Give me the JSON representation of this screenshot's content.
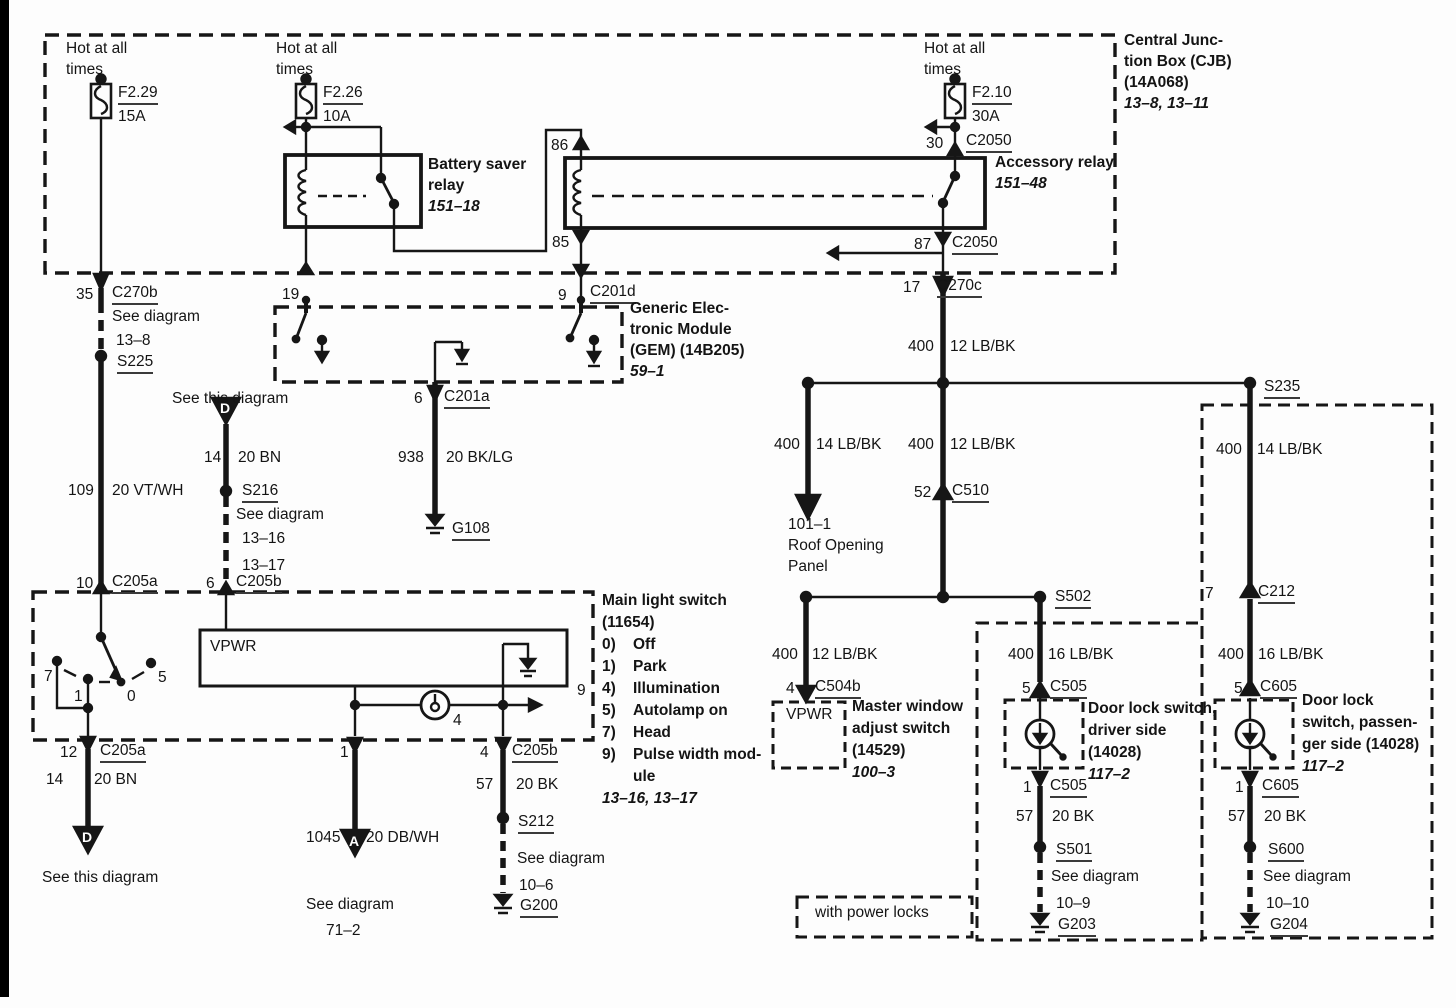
{
  "colors": {
    "ink": "#161616",
    "paper": "#fdfdfd"
  },
  "labels": [
    {
      "n": "hot-at-all-times-1a",
      "t": "Hot at all",
      "x": 66,
      "y": 40,
      "c": ""
    },
    {
      "n": "hot-at-all-times-1b",
      "t": "times",
      "x": 66,
      "y": 61,
      "c": ""
    },
    {
      "n": "fuse-f229-name",
      "t": "F2.29",
      "x": 118,
      "y": 84,
      "c": "u"
    },
    {
      "n": "fuse-f229-rating",
      "t": "15A",
      "x": 118,
      "y": 108,
      "c": ""
    },
    {
      "n": "hot-at-all-times-2a",
      "t": "Hot at all",
      "x": 276,
      "y": 40,
      "c": ""
    },
    {
      "n": "hot-at-all-times-2b",
      "t": "times",
      "x": 276,
      "y": 61,
      "c": ""
    },
    {
      "n": "fuse-f226-name",
      "t": "F2.26",
      "x": 323,
      "y": 84,
      "c": "u"
    },
    {
      "n": "fuse-f226-rating",
      "t": "10A",
      "x": 323,
      "y": 108,
      "c": ""
    },
    {
      "n": "hot-at-all-times-3a",
      "t": "Hot at all",
      "x": 924,
      "y": 40,
      "c": ""
    },
    {
      "n": "hot-at-all-times-3b",
      "t": "times",
      "x": 924,
      "y": 61,
      "c": ""
    },
    {
      "n": "fuse-f210-name",
      "t": "F2.10",
      "x": 972,
      "y": 84,
      "c": "u"
    },
    {
      "n": "fuse-f210-rating",
      "t": "30A",
      "x": 972,
      "y": 108,
      "c": ""
    },
    {
      "n": "cjb-title-1",
      "t": "Central Junc-",
      "x": 1124,
      "y": 32,
      "c": "b"
    },
    {
      "n": "cjb-title-2",
      "t": "tion Box (CJB)",
      "x": 1124,
      "y": 53,
      "c": "b"
    },
    {
      "n": "cjb-title-3",
      "t": "(14A068)",
      "x": 1124,
      "y": 74,
      "c": "b"
    },
    {
      "n": "cjb-page-ref",
      "t": "13–8, 13–11",
      "x": 1124,
      "y": 95,
      "c": "bi"
    },
    {
      "n": "battery-saver-relay-1",
      "t": "Battery saver",
      "x": 428,
      "y": 156,
      "c": "b"
    },
    {
      "n": "battery-saver-relay-2",
      "t": "relay",
      "x": 428,
      "y": 177,
      "c": "b"
    },
    {
      "n": "battery-saver-relay-ref",
      "t": "151–18",
      "x": 428,
      "y": 198,
      "c": "bi"
    },
    {
      "n": "accessory-relay-1",
      "t": "Accessory relay",
      "x": 995,
      "y": 154,
      "c": "b"
    },
    {
      "n": "accessory-relay-ref",
      "t": "151–48",
      "x": 995,
      "y": 175,
      "c": "bi"
    },
    {
      "n": "pin-86",
      "t": "86",
      "x": 551,
      "y": 137,
      "c": ""
    },
    {
      "n": "pin-85",
      "t": "85",
      "x": 552,
      "y": 234,
      "c": ""
    },
    {
      "n": "pin-30",
      "t": "30",
      "x": 926,
      "y": 135,
      "c": ""
    },
    {
      "n": "conn-c2050-top",
      "t": "C2050",
      "x": 966,
      "y": 132,
      "c": "u"
    },
    {
      "n": "pin-87",
      "t": "87",
      "x": 914,
      "y": 236,
      "c": ""
    },
    {
      "n": "conn-c2050-bottom",
      "t": "C2050",
      "x": 952,
      "y": 234,
      "c": "u"
    },
    {
      "n": "pin-35",
      "t": "35",
      "x": 76,
      "y": 286,
      "c": ""
    },
    {
      "n": "conn-c270b",
      "t": "C270b",
      "x": 112,
      "y": 284,
      "c": "u"
    },
    {
      "n": "pin-19",
      "t": "19",
      "x": 282,
      "y": 286,
      "c": ""
    },
    {
      "n": "pin-9-c201d",
      "t": "9",
      "x": 558,
      "y": 287,
      "c": ""
    },
    {
      "n": "conn-c201d",
      "t": "C201d",
      "x": 590,
      "y": 283,
      "c": "u"
    },
    {
      "n": "pin-17",
      "t": "17",
      "x": 903,
      "y": 279,
      "c": ""
    },
    {
      "n": "conn-c270c",
      "t": "C270c",
      "x": 937,
      "y": 277,
      "c": "u"
    },
    {
      "n": "see-diagram-13-8a",
      "t": "See diagram",
      "x": 112,
      "y": 308,
      "c": ""
    },
    {
      "n": "see-diagram-13-8b",
      "t": "13–8",
      "x": 116,
      "y": 332,
      "c": ""
    },
    {
      "n": "splice-s225",
      "t": "S225",
      "x": 117,
      "y": 353,
      "c": "u"
    },
    {
      "n": "gem-title-1",
      "t": "Generic Elec-",
      "x": 630,
      "y": 300,
      "c": "b"
    },
    {
      "n": "gem-title-2",
      "t": "tronic Module",
      "x": 630,
      "y": 321,
      "c": "b"
    },
    {
      "n": "gem-title-3",
      "t": "(GEM) (14B205)",
      "x": 630,
      "y": 342,
      "c": "b"
    },
    {
      "n": "gem-page-ref",
      "t": "59–1",
      "x": 630,
      "y": 363,
      "c": "bi"
    },
    {
      "n": "pin-6-c201a",
      "t": "6",
      "x": 414,
      "y": 390,
      "c": ""
    },
    {
      "n": "conn-c201a",
      "t": "C201a",
      "x": 444,
      "y": 388,
      "c": "u"
    },
    {
      "n": "wire-938-num",
      "t": "938",
      "x": 398,
      "y": 449,
      "c": ""
    },
    {
      "n": "wire-938-color",
      "t": "20 BK/LG",
      "x": 446,
      "y": 449,
      "c": ""
    },
    {
      "n": "ground-g108",
      "t": "G108",
      "x": 452,
      "y": 520,
      "c": "u"
    },
    {
      "n": "see-this-diagram-top",
      "t": "See this diagram",
      "x": 172,
      "y": 390,
      "c": ""
    },
    {
      "n": "wire-14-top-num",
      "t": "14",
      "x": 204,
      "y": 449,
      "c": ""
    },
    {
      "n": "wire-14-top-color",
      "t": "20 BN",
      "x": 238,
      "y": 449,
      "c": ""
    },
    {
      "n": "splice-s216",
      "t": "S216",
      "x": 242,
      "y": 482,
      "c": "u"
    },
    {
      "n": "see-diagram-1316a",
      "t": "See diagram",
      "x": 236,
      "y": 506,
      "c": ""
    },
    {
      "n": "see-diagram-1316b",
      "t": "13–16",
      "x": 242,
      "y": 530,
      "c": ""
    },
    {
      "n": "see-diagram-1316c",
      "t": "13–17",
      "x": 242,
      "y": 557,
      "c": ""
    },
    {
      "n": "wire-109-num",
      "t": "109",
      "x": 68,
      "y": 482,
      "c": ""
    },
    {
      "n": "wire-109-color",
      "t": "20 VT/WH",
      "x": 112,
      "y": 482,
      "c": ""
    },
    {
      "n": "pin-10",
      "t": "10",
      "x": 76,
      "y": 575,
      "c": ""
    },
    {
      "n": "conn-c205a-top",
      "t": "C205a",
      "x": 112,
      "y": 573,
      "c": "u"
    },
    {
      "n": "pin-6-c205b",
      "t": "6",
      "x": 206,
      "y": 575,
      "c": ""
    },
    {
      "n": "conn-c205b-top",
      "t": "C205b",
      "x": 236,
      "y": 573,
      "c": "u"
    },
    {
      "n": "mls-title-1",
      "t": "Main light switch",
      "x": 602,
      "y": 592,
      "c": "b"
    },
    {
      "n": "mls-title-2",
      "t": "(11654)",
      "x": 602,
      "y": 614,
      "c": "b"
    },
    {
      "n": "mls-opt0-num",
      "t": "0)",
      "x": 602,
      "y": 636,
      "c": "b"
    },
    {
      "n": "mls-opt0-val",
      "t": "Off",
      "x": 633,
      "y": 636,
      "c": "b"
    },
    {
      "n": "mls-opt1-num",
      "t": "1)",
      "x": 602,
      "y": 658,
      "c": "b"
    },
    {
      "n": "mls-opt1-val",
      "t": "Park",
      "x": 633,
      "y": 658,
      "c": "b"
    },
    {
      "n": "mls-opt4-num",
      "t": "4)",
      "x": 602,
      "y": 680,
      "c": "b"
    },
    {
      "n": "mls-opt4-val",
      "t": "Illumination",
      "x": 633,
      "y": 680,
      "c": "b"
    },
    {
      "n": "mls-opt5-num",
      "t": "5)",
      "x": 602,
      "y": 702,
      "c": "b"
    },
    {
      "n": "mls-opt5-val",
      "t": "Autolamp on",
      "x": 633,
      "y": 702,
      "c": "b"
    },
    {
      "n": "mls-opt7-num",
      "t": "7)",
      "x": 602,
      "y": 724,
      "c": "b"
    },
    {
      "n": "mls-opt7-val",
      "t": "Head",
      "x": 633,
      "y": 724,
      "c": "b"
    },
    {
      "n": "mls-opt9-num",
      "t": "9)",
      "x": 602,
      "y": 746,
      "c": "b"
    },
    {
      "n": "mls-opt9-val",
      "t": "Pulse width mod-",
      "x": 633,
      "y": 746,
      "c": "b"
    },
    {
      "n": "mls-opt9-val2",
      "t": "ule",
      "x": 633,
      "y": 768,
      "c": "b"
    },
    {
      "n": "mls-page-ref",
      "t": "13–16, 13–17",
      "x": 602,
      "y": 790,
      "c": "bi"
    },
    {
      "n": "vpwr-mls",
      "t": "VPWR",
      "x": 210,
      "y": 638,
      "c": ""
    },
    {
      "n": "rotary-pos-7",
      "t": "7",
      "x": 44,
      "y": 668,
      "c": ""
    },
    {
      "n": "rotary-pos-1",
      "t": "1",
      "x": 74,
      "y": 688,
      "c": ""
    },
    {
      "n": "rotary-pos-0",
      "t": "0",
      "x": 127,
      "y": 688,
      "c": ""
    },
    {
      "n": "rotary-pos-5",
      "t": "5",
      "x": 158,
      "y": 669,
      "c": ""
    },
    {
      "n": "pin-9-mls",
      "t": "9",
      "x": 577,
      "y": 682,
      "c": ""
    },
    {
      "n": "lamp-pin-4",
      "t": "4",
      "x": 453,
      "y": 712,
      "c": ""
    },
    {
      "n": "pin-12",
      "t": "12",
      "x": 60,
      "y": 744,
      "c": ""
    },
    {
      "n": "conn-c205a-bottom",
      "t": "C205a",
      "x": 100,
      "y": 742,
      "c": "u"
    },
    {
      "n": "pin-1-mls",
      "t": "1",
      "x": 340,
      "y": 744,
      "c": ""
    },
    {
      "n": "pin-4-mls",
      "t": "4",
      "x": 480,
      "y": 744,
      "c": ""
    },
    {
      "n": "conn-c205b-bottom",
      "t": "C205b",
      "x": 512,
      "y": 742,
      "c": "u"
    },
    {
      "n": "wire-14-bot-num",
      "t": "14",
      "x": 46,
      "y": 771,
      "c": ""
    },
    {
      "n": "wire-14-bot-color",
      "t": "20 BN",
      "x": 94,
      "y": 771,
      "c": ""
    },
    {
      "n": "see-this-diagram-bottom",
      "t": "See this diagram",
      "x": 42,
      "y": 869,
      "c": ""
    },
    {
      "n": "wire-1045-num",
      "t": "1045",
      "x": 306,
      "y": 829,
      "c": ""
    },
    {
      "n": "wire-1045-color",
      "t": "20 DB/WH",
      "x": 366,
      "y": 829,
      "c": ""
    },
    {
      "n": "see-diagram-712a",
      "t": "See diagram",
      "x": 306,
      "y": 896,
      "c": ""
    },
    {
      "n": "see-diagram-712b",
      "t": "71–2",
      "x": 326,
      "y": 922,
      "c": ""
    },
    {
      "n": "wire-57-mls-num",
      "t": "57",
      "x": 476,
      "y": 776,
      "c": ""
    },
    {
      "n": "wire-57-mls-color",
      "t": "20 BK",
      "x": 516,
      "y": 776,
      "c": ""
    },
    {
      "n": "splice-s212",
      "t": "S212",
      "x": 518,
      "y": 813,
      "c": "u"
    },
    {
      "n": "see-diagram-106a",
      "t": "See diagram",
      "x": 517,
      "y": 850,
      "c": ""
    },
    {
      "n": "see-diagram-106b",
      "t": "10–6",
      "x": 519,
      "y": 877,
      "c": ""
    },
    {
      "n": "ground-g200",
      "t": "G200",
      "x": 520,
      "y": 897,
      "c": "u"
    },
    {
      "n": "wire-400a-num",
      "t": "400",
      "x": 908,
      "y": 338,
      "c": ""
    },
    {
      "n": "wire-400a-color",
      "t": "12 LB/BK",
      "x": 950,
      "y": 338,
      "c": ""
    },
    {
      "n": "wire-400b-num",
      "t": "400",
      "x": 774,
      "y": 436,
      "c": ""
    },
    {
      "n": "wire-400b-color",
      "t": "14 LB/BK",
      "x": 816,
      "y": 436,
      "c": ""
    },
    {
      "n": "wire-400c-num",
      "t": "400",
      "x": 908,
      "y": 436,
      "c": ""
    },
    {
      "n": "wire-400c-color",
      "t": "12 LB/BK",
      "x": 950,
      "y": 436,
      "c": ""
    },
    {
      "n": "splice-s235",
      "t": "S235",
      "x": 1264,
      "y": 378,
      "c": "u"
    },
    {
      "n": "wire-400d-num",
      "t": "400",
      "x": 1216,
      "y": 441,
      "c": ""
    },
    {
      "n": "wire-400d-color",
      "t": "14 LB/BK",
      "x": 1257,
      "y": 441,
      "c": ""
    },
    {
      "n": "pin-52",
      "t": "52",
      "x": 914,
      "y": 484,
      "c": ""
    },
    {
      "n": "conn-c510",
      "t": "C510",
      "x": 952,
      "y": 482,
      "c": "u"
    },
    {
      "n": "roof-panel-ref",
      "t": "101–1",
      "x": 788,
      "y": 516,
      "c": ""
    },
    {
      "n": "roof-panel-1",
      "t": "Roof Opening",
      "x": 788,
      "y": 537,
      "c": ""
    },
    {
      "n": "roof-panel-2",
      "t": "Panel",
      "x": 788,
      "y": 558,
      "c": ""
    },
    {
      "n": "splice-s502",
      "t": "S502",
      "x": 1055,
      "y": 588,
      "c": "u"
    },
    {
      "n": "pin-7-c212",
      "t": "7",
      "x": 1205,
      "y": 585,
      "c": ""
    },
    {
      "n": "conn-c212",
      "t": "C212",
      "x": 1258,
      "y": 583,
      "c": "u"
    },
    {
      "n": "wire-400e-num",
      "t": "400",
      "x": 772,
      "y": 646,
      "c": ""
    },
    {
      "n": "wire-400e-color",
      "t": "12 LB/BK",
      "x": 812,
      "y": 646,
      "c": ""
    },
    {
      "n": "pin-4-c504b",
      "t": "4",
      "x": 786,
      "y": 680,
      "c": ""
    },
    {
      "n": "conn-c504b",
      "t": "C504b",
      "x": 815,
      "y": 678,
      "c": "u"
    },
    {
      "n": "vpwr-mws",
      "t": "VPWR",
      "x": 786,
      "y": 706,
      "c": ""
    },
    {
      "n": "mws-title-1",
      "t": "Master window",
      "x": 852,
      "y": 698,
      "c": "b"
    },
    {
      "n": "mws-title-2",
      "t": "adjust switch",
      "x": 852,
      "y": 720,
      "c": "b"
    },
    {
      "n": "mws-title-3",
      "t": "(14529)",
      "x": 852,
      "y": 742,
      "c": "b"
    },
    {
      "n": "mws-page-ref",
      "t": "100–3",
      "x": 852,
      "y": 764,
      "c": "bi"
    },
    {
      "n": "wire-400f-num",
      "t": "400",
      "x": 1008,
      "y": 646,
      "c": ""
    },
    {
      "n": "wire-400f-color",
      "t": "16 LB/BK",
      "x": 1048,
      "y": 646,
      "c": ""
    },
    {
      "n": "pin-5-c505",
      "t": "5",
      "x": 1022,
      "y": 680,
      "c": ""
    },
    {
      "n": "conn-c505-top",
      "t": "C505",
      "x": 1050,
      "y": 678,
      "c": "u"
    },
    {
      "n": "dls-driver-1",
      "t": "Door lock switch,",
      "x": 1088,
      "y": 700,
      "c": "b"
    },
    {
      "n": "dls-driver-2",
      "t": "driver side",
      "x": 1088,
      "y": 722,
      "c": "b"
    },
    {
      "n": "dls-driver-3",
      "t": "(14028)",
      "x": 1088,
      "y": 744,
      "c": "b"
    },
    {
      "n": "dls-driver-ref",
      "t": "117–2",
      "x": 1088,
      "y": 766,
      "c": "bi"
    },
    {
      "n": "pin-1-c505",
      "t": "1",
      "x": 1023,
      "y": 779,
      "c": ""
    },
    {
      "n": "conn-c505-bottom",
      "t": "C505",
      "x": 1050,
      "y": 777,
      "c": "u"
    },
    {
      "n": "wire-57d-num",
      "t": "57",
      "x": 1016,
      "y": 808,
      "c": ""
    },
    {
      "n": "wire-57d-color",
      "t": "20 BK",
      "x": 1052,
      "y": 808,
      "c": ""
    },
    {
      "n": "splice-s501",
      "t": "S501",
      "x": 1056,
      "y": 841,
      "c": "u"
    },
    {
      "n": "see-diagram-109a",
      "t": "See diagram",
      "x": 1051,
      "y": 868,
      "c": ""
    },
    {
      "n": "see-diagram-109b",
      "t": "10–9",
      "x": 1056,
      "y": 895,
      "c": ""
    },
    {
      "n": "ground-g203",
      "t": "G203",
      "x": 1058,
      "y": 916,
      "c": "u"
    },
    {
      "n": "wire-400g-num",
      "t": "400",
      "x": 1218,
      "y": 646,
      "c": ""
    },
    {
      "n": "wire-400g-color",
      "t": "16 LB/BK",
      "x": 1258,
      "y": 646,
      "c": ""
    },
    {
      "n": "pin-5-c605",
      "t": "5",
      "x": 1234,
      "y": 680,
      "c": ""
    },
    {
      "n": "conn-c605-top",
      "t": "C605",
      "x": 1260,
      "y": 678,
      "c": "u"
    },
    {
      "n": "dls-pass-1",
      "t": "Door lock",
      "x": 1302,
      "y": 692,
      "c": "b"
    },
    {
      "n": "dls-pass-2",
      "t": "switch, passen-",
      "x": 1302,
      "y": 714,
      "c": "b"
    },
    {
      "n": "dls-pass-3",
      "t": "ger side (14028)",
      "x": 1302,
      "y": 736,
      "c": "b"
    },
    {
      "n": "dls-pass-ref",
      "t": "117–2",
      "x": 1302,
      "y": 758,
      "c": "bi"
    },
    {
      "n": "pin-1-c605",
      "t": "1",
      "x": 1235,
      "y": 779,
      "c": ""
    },
    {
      "n": "conn-c605-bottom",
      "t": "C605",
      "x": 1262,
      "y": 777,
      "c": "u"
    },
    {
      "n": "wire-57p-num",
      "t": "57",
      "x": 1228,
      "y": 808,
      "c": ""
    },
    {
      "n": "wire-57p-color",
      "t": "20 BK",
      "x": 1264,
      "y": 808,
      "c": ""
    },
    {
      "n": "splice-s600",
      "t": "S600",
      "x": 1268,
      "y": 841,
      "c": "u"
    },
    {
      "n": "see-diagram-1010a",
      "t": "See diagram",
      "x": 1263,
      "y": 868,
      "c": ""
    },
    {
      "n": "see-diagram-1010b",
      "t": "10–10",
      "x": 1266,
      "y": 895,
      "c": ""
    },
    {
      "n": "ground-g204",
      "t": "G204",
      "x": 1270,
      "y": 916,
      "c": "u"
    },
    {
      "n": "with-power-locks",
      "t": "with power locks",
      "x": 815,
      "y": 904,
      "c": ""
    },
    {
      "n": "offpage-letter-d-top",
      "t": "D",
      "x": 220,
      "y": 400,
      "c": "w"
    },
    {
      "n": "offpage-letter-d-bottom",
      "t": "D",
      "x": 82,
      "y": 829,
      "c": "w"
    },
    {
      "n": "offpage-letter-a",
      "t": "A",
      "x": 349,
      "y": 833,
      "c": "w"
    }
  ]
}
